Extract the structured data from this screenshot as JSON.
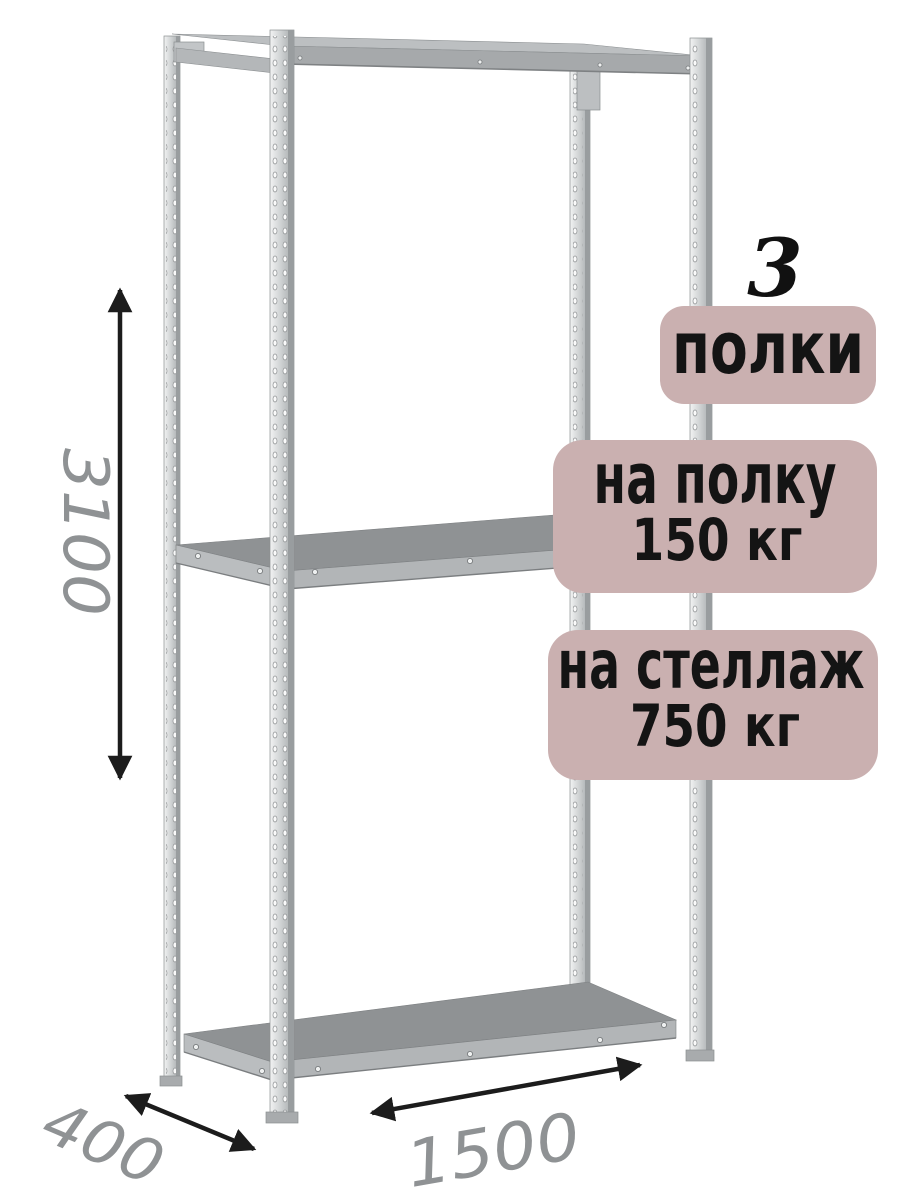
{
  "product": {
    "illustration": "metal-boltless-shelving-rack-3-shelves",
    "shelf_count": "3",
    "badges": {
      "shelves": {
        "label": "полки"
      },
      "per_shelf": {
        "line1": "на полку",
        "line2": "150 кг"
      },
      "per_rack": {
        "line1": "на стеллаж",
        "line2": "750 кг"
      }
    },
    "dimensions": {
      "height_mm": "3100",
      "width_mm": "1500",
      "depth_mm": "400"
    }
  },
  "icons": {
    "height_arrow": "double-headed-vertical-arrow",
    "width_arrow": "double-headed-diagonal-arrow",
    "depth_arrow": "double-headed-diagonal-arrow"
  },
  "colors": {
    "badge_bg": "#cab0b0",
    "badge_text": "#141414",
    "count_text": "#111111",
    "dimension_text": "#8f9294",
    "arrow": "#1c1c1c",
    "shelf_top": "#8f9294",
    "shelf_edge": "#b2b5b7",
    "shelf_side": "#babdbf",
    "post_outline": "#8b8f91"
  }
}
